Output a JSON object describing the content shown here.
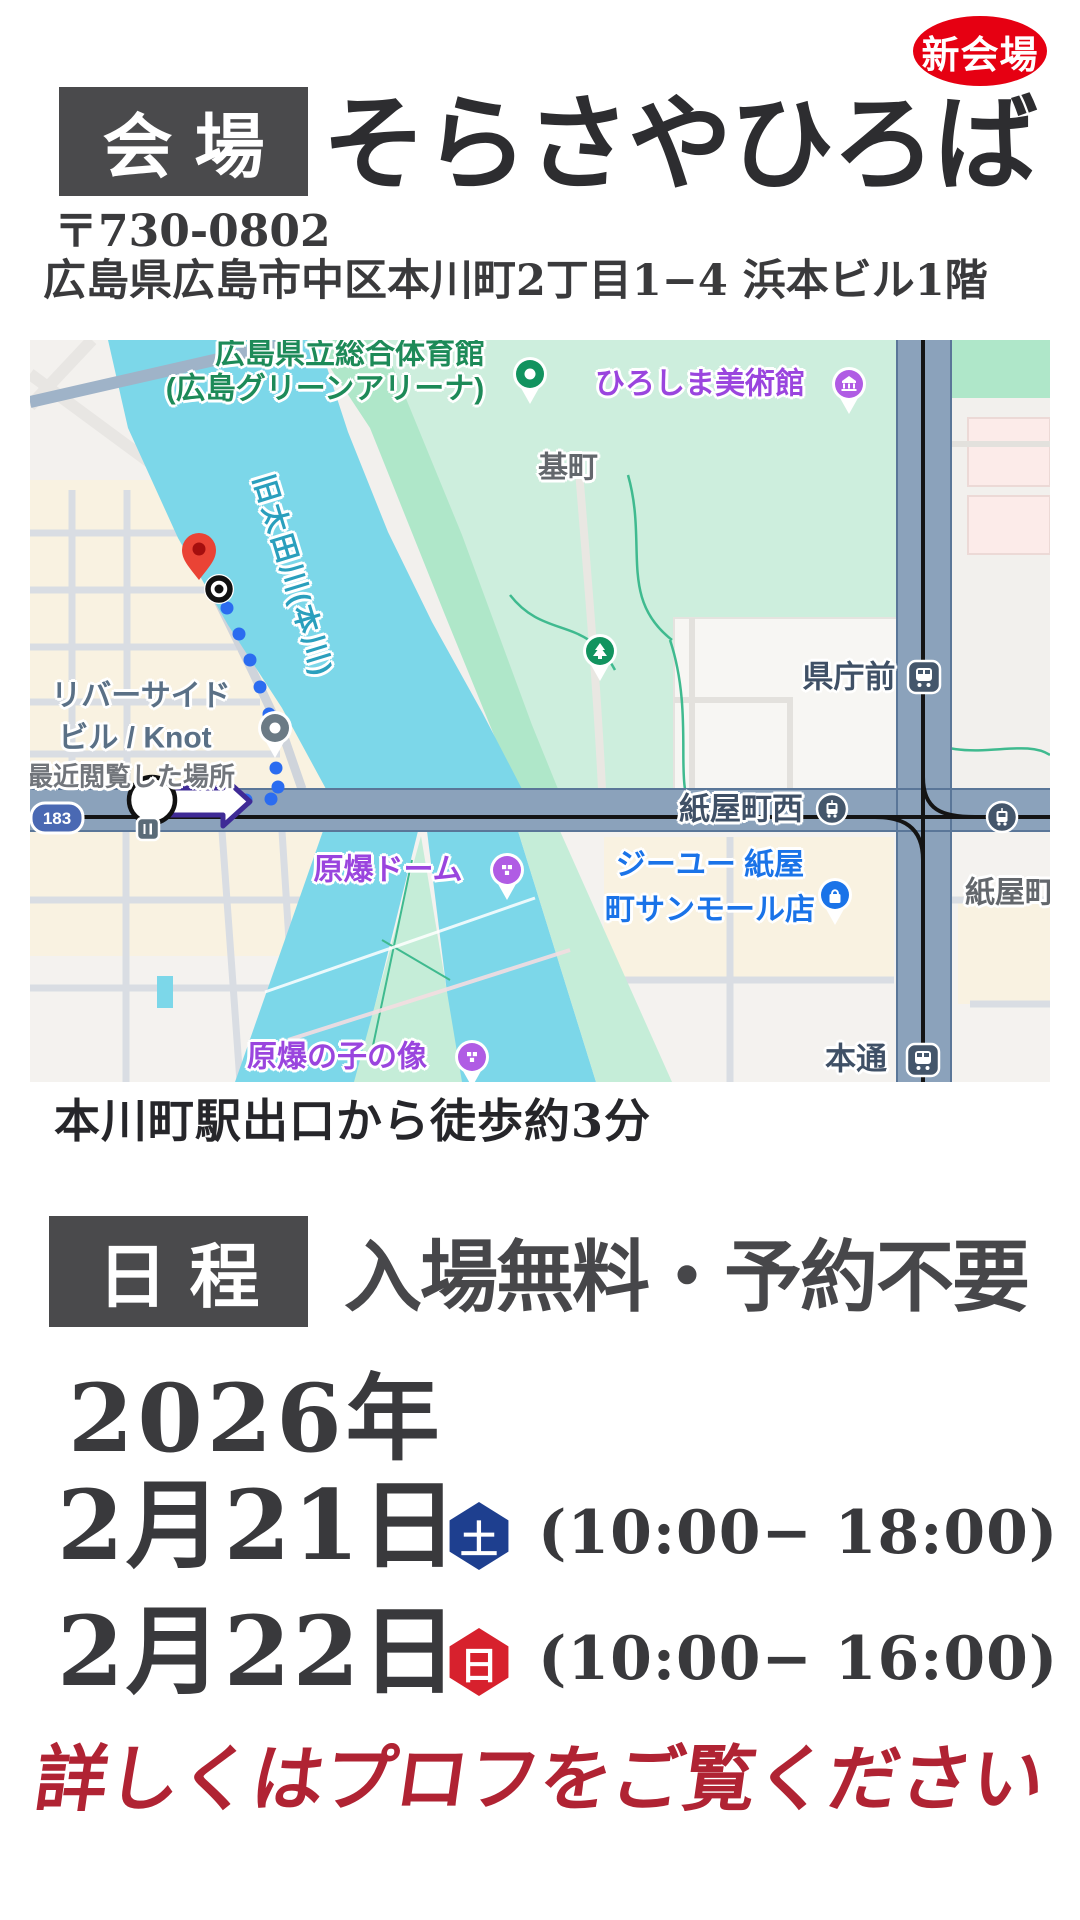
{
  "badge": {
    "label": "新会場"
  },
  "venue": {
    "section_label": "会場",
    "name": "そらさやひろば",
    "postal_code": "〒730-0802",
    "address": "広島県広島市中区本川町2丁目1−4 浜本ビル1階",
    "access_note": "本川町駅出口から徒歩約3分"
  },
  "map": {
    "labels": {
      "gym_line1": "広島県立総合体育館",
      "gym_line2": "(広島グリーンアリーナ)",
      "museum": "ひろしま美術館",
      "motomachi": "基町",
      "river": "旧太田川(本川)",
      "kencho_mae": "県庁前",
      "riverside_line1": "リバーサイド",
      "riverside_line2": "ビル / Knot",
      "recent_place": "最近閲覧した場所",
      "kamiyacho_nishi": "紙屋町西",
      "genbaku_dome": "原爆ドーム",
      "gu_line1": "ジーユー 紙屋",
      "gu_line2": "町サンモール店",
      "kamiyacho": "紙屋町",
      "children_statue": "原爆の子の像",
      "hondori": "本通",
      "route_shield": "183"
    }
  },
  "schedule": {
    "section_label": "日程",
    "admission": "入場無料・予約不要",
    "year": "2026年",
    "dates": [
      {
        "date": "2月21日",
        "day": "土",
        "time": "(10:00− 18:00)"
      },
      {
        "date": "2月22日",
        "day": "日",
        "time": "(10:00− 16:00)"
      }
    ]
  },
  "footer": {
    "note": "詳しくはプロフをご覧ください"
  },
  "colors": {
    "badge_red": "#e60012",
    "section_box_gray": "#4a4a4c",
    "saturday_blue": "#1e3f8f",
    "sunday_red": "#d7212d",
    "footer_red": "#b02333",
    "map_river": "#7cd7e9",
    "map_park": "#cdeedd",
    "map_road": "#8ba2bb"
  }
}
